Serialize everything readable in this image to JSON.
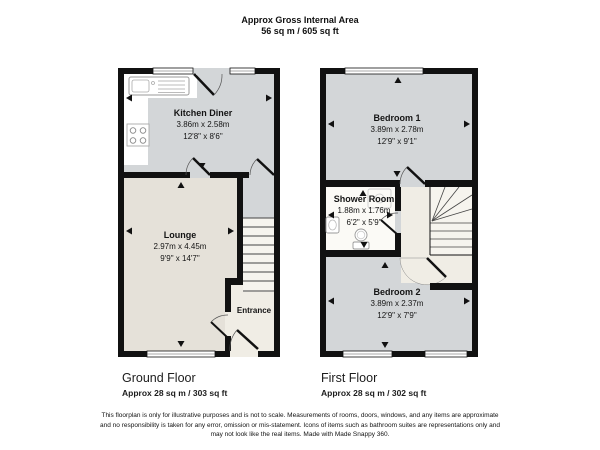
{
  "header": {
    "title": "Approx Gross Internal Area",
    "area": "56 sq m / 605 sq ft"
  },
  "ground_floor": {
    "label": "Ground Floor",
    "area_label": "Approx 28 sq m / 303 sq ft",
    "rooms": {
      "kitchen_diner": {
        "name": "Kitchen Diner",
        "metric": "3.86m x 2.58m",
        "imperial": "12'8\" x 8'6\""
      },
      "lounge": {
        "name": "Lounge",
        "metric": "2.97m x 4.45m",
        "imperial": "9'9\" x 14'7\""
      },
      "entrance": {
        "name": "Entrance"
      }
    }
  },
  "first_floor": {
    "label": "First Floor",
    "area_label": "Approx 28 sq m / 302 sq ft",
    "rooms": {
      "bedroom_1": {
        "name": "Bedroom 1",
        "metric": "3.89m x 2.78m",
        "imperial": "12'9\" x 9'1\""
      },
      "shower_room": {
        "name": "Shower Room",
        "metric": "1.88m x 1.76m",
        "imperial": "6'2\" x 5'9\""
      },
      "bedroom_2": {
        "name": "Bedroom 2",
        "metric": "3.89m x 2.37m",
        "imperial": "12'9\" x 7'9\""
      }
    }
  },
  "footer": {
    "line1": "This floorplan is only for illustrative purposes and is not to scale. Measurements of rooms, doors, windows, and any items are approximate",
    "line2": "and no responsibility is taken for any error, omission or mis-statement. Icons of items such as bathroom suites are representations only and",
    "line3": "may not look like the real items. Made with Made Snappy 360."
  },
  "colors": {
    "wall": "#111111",
    "room_gray": "#d3d6d8",
    "room_beige": "#e5e1d9",
    "entrance_cream": "#f0ede5",
    "stairs_white": "#f6f4ee",
    "shower_white": "#fbfaf6"
  }
}
